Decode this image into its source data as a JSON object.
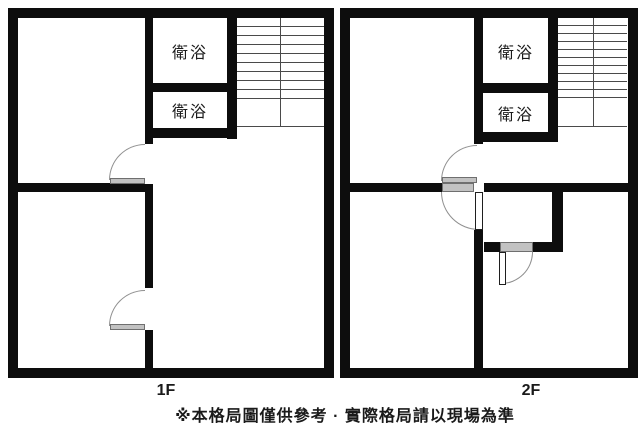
{
  "floors": [
    {
      "label": "1F",
      "bathrooms": [
        "衛浴",
        "衛浴"
      ]
    },
    {
      "label": "2F",
      "bathrooms": [
        "衛浴",
        "衛浴"
      ]
    }
  ],
  "note": "※本格局圖僅供參考 · 實際格局請以現場為準",
  "colors": {
    "wall": "#0d0d0d",
    "background": "#ffffff",
    "door_arc": "#8f8f8f",
    "door_leaf": "#c2c2c2",
    "stair_line": "#4a4a4a",
    "text": "#1a1a1a"
  }
}
